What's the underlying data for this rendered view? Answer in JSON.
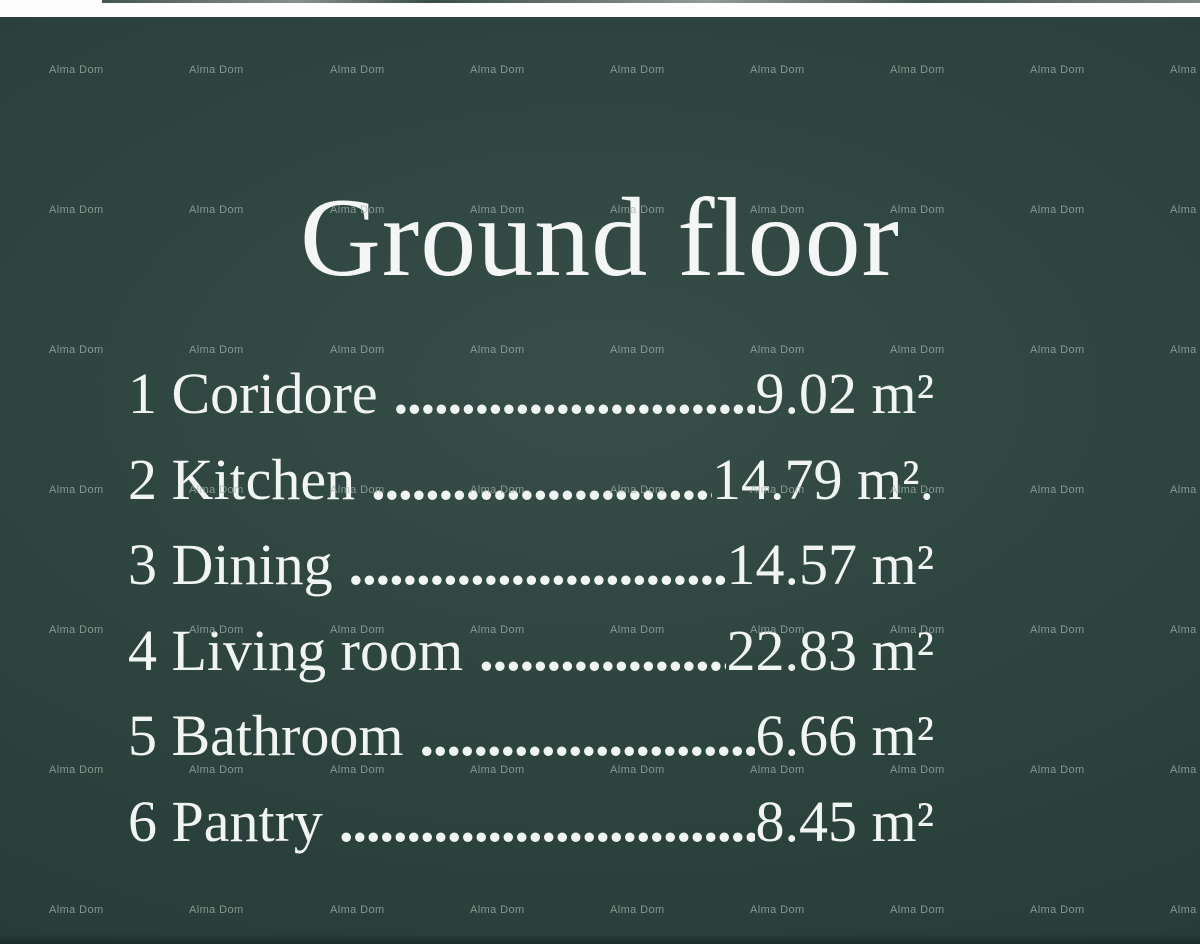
{
  "page": {
    "title": "Ground floor",
    "watermark_label": "Alma Dom",
    "colors": {
      "board_background": "#2d443f",
      "text": "#f1f5f2",
      "watermark": "#a0b0aa",
      "top_strip": "#fdfdfd"
    }
  },
  "rooms": [
    {
      "label": "1 Coridore",
      "dots": "....................................",
      "value": "9.02 m²"
    },
    {
      "label": "2 Kitchen",
      "dots": "....................................",
      "value": "14.79 m²."
    },
    {
      "label": "3 Dining",
      "dots": "....................................",
      "value": "14.57 m²"
    },
    {
      "label": "4 Living room",
      "dots": "....................................",
      "value": "22.83 m²"
    },
    {
      "label": "5 Bathroom",
      "dots": "....................................",
      "value": "6.66 m²"
    },
    {
      "label": "6 Pantry",
      "dots": "....................................",
      "value": "8.45 m²"
    }
  ]
}
